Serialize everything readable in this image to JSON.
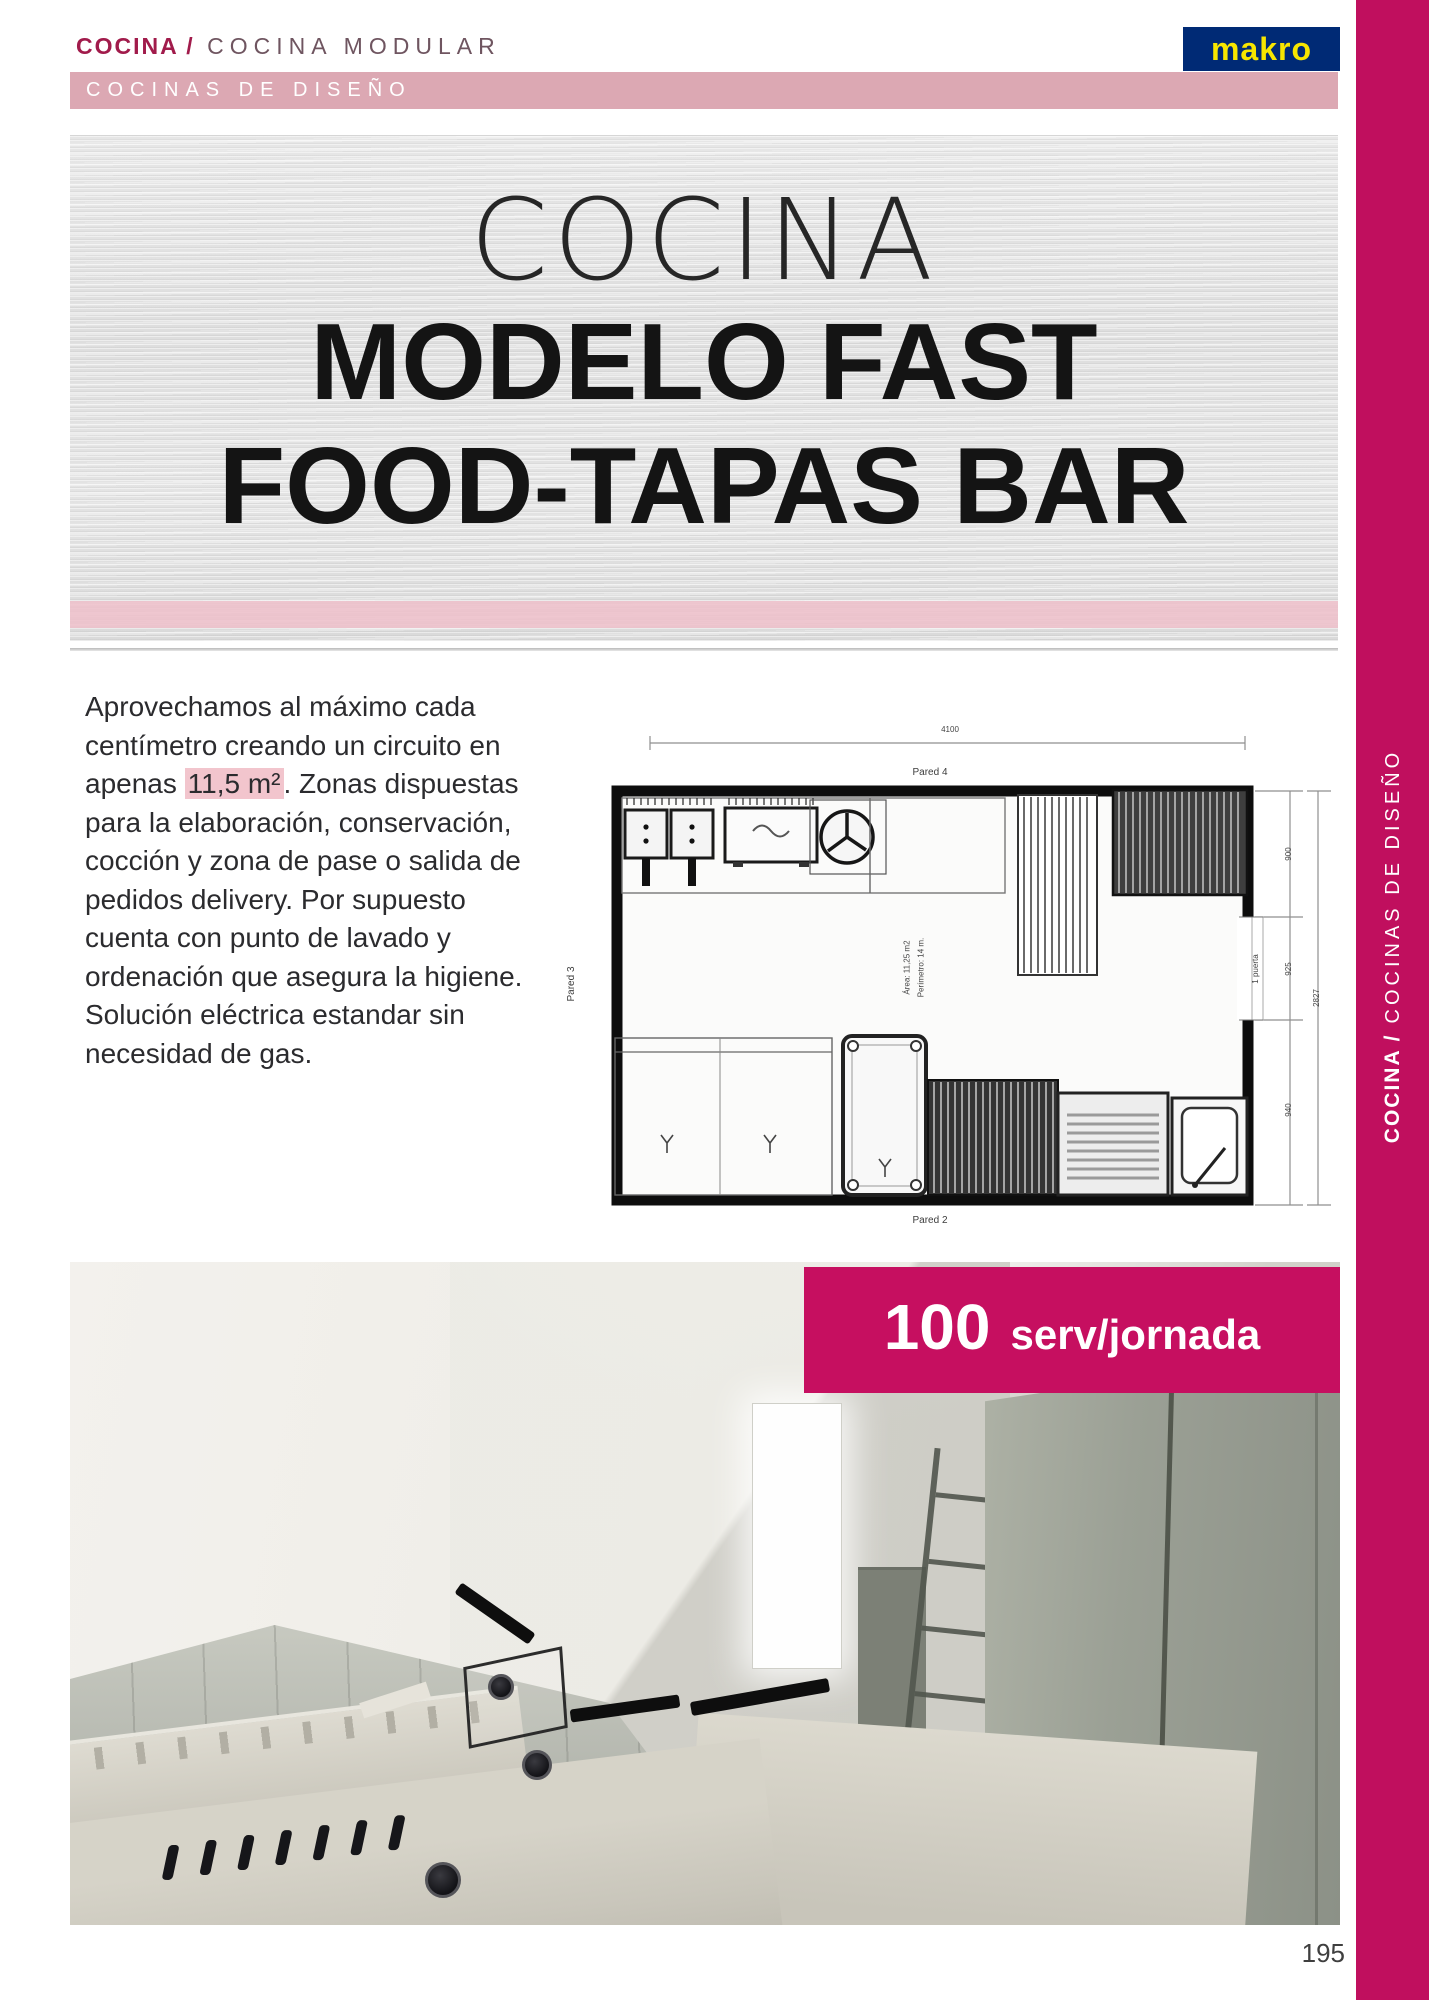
{
  "header": {
    "breadcrumb": {
      "bold": "COCINA /",
      "light": "COCINA MODULAR"
    },
    "logo_text": "makro",
    "category_bar": "COCINAS DE DISEÑO"
  },
  "banner": {
    "line1": "COCINA",
    "line2": "MODELO FAST",
    "line3": "FOOD-TAPAS BAR"
  },
  "intro": {
    "before": "Aprovechamos al máximo cada centímetro creando un circuito en apenas ",
    "highlight": "11,5 m²",
    "after": ". Zonas dispuestas para la elaboración, conservación, cocción y zona de pase o salida de pedidos delivery. Por supuesto cuenta con punto de lavado y ordenación que asegura la higiene. Solución eléctrica estandar sin necesidad de gas."
  },
  "floorplan": {
    "dim_width": "4100",
    "wall_top_label": "Pared 4",
    "wall_bottom_label": "Pared 2",
    "wall_left_label": "Pared 3",
    "door_label": "1 puerta",
    "dim_seg1": "900",
    "dim_seg2": "925",
    "dim_seg3": "940",
    "dim_total": "2827",
    "area_line1": "Área: 11,25 m2",
    "area_line2": "Perímetro: 14 m."
  },
  "badge": {
    "value": "100",
    "unit": "serv/jornada"
  },
  "sidebar": {
    "bold": "COCINA /",
    "light": "COCINAS DE DISEÑO"
  },
  "page": {
    "number": "195"
  },
  "colors": {
    "accent_magenta": "#c60f60",
    "rail_magenta": "#c00f5e",
    "category_pink": "#dca8b3",
    "banner_strip_pink": "#efc0ca",
    "highlight_pink": "#f2c5cd",
    "logo_bg_blue": "#002a75",
    "logo_text_yellow": "#f7e600",
    "breadcrumb_crimson": "#a11b4b"
  }
}
